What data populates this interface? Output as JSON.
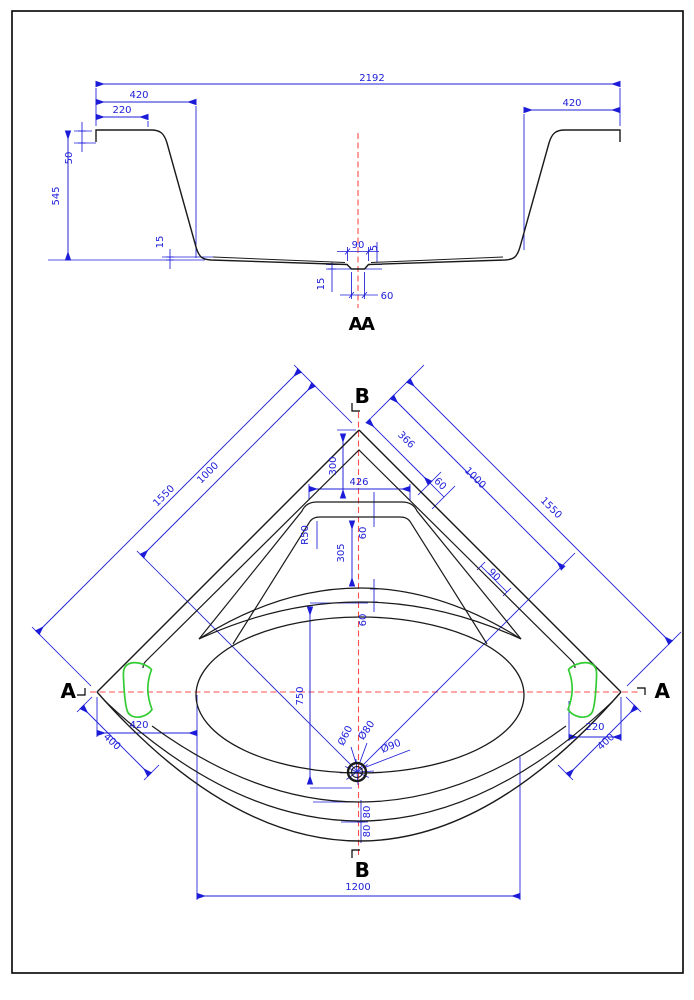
{
  "drawing_title": "",
  "colors": {
    "geometry": "#1a1a1a",
    "dimension": "#1c1cd8",
    "centerline": "#ff4d4d",
    "headrest": "#33cc33",
    "marker": "#000000",
    "page_border": "#000000",
    "background": "#ffffff"
  },
  "section_view": {
    "label": "AA",
    "dims": {
      "overall_width": "2192",
      "flange_left": "420",
      "flange_left_inner": "220",
      "flange_right": "420",
      "lip_height": "50",
      "total_height": "545",
      "bottom_step_left": "15",
      "recess_width_top": "90",
      "recess_depth": "5",
      "recess_side": "15",
      "recess_width_bottom": "60"
    }
  },
  "plan_view": {
    "markers": {
      "a": "A",
      "b": "B"
    },
    "dims": {
      "edge_left_total": "1550",
      "edge_left_to_drain": "1000",
      "edge_right_total": "1550",
      "edge_right_to_drain": "1000",
      "corner_to_shelf": "366",
      "shelf_edge_offset": "60",
      "rim_inner_gap": "90",
      "corner_drop": "300",
      "shelf_width": "426",
      "shelf_corner_radius": "R50",
      "shelf_height": "305",
      "shelf_gap": "60",
      "bowl_gap": "60",
      "drain_offset": "750",
      "drain_dia_1": "Ø60",
      "drain_dia_2": "Ø80",
      "drain_dia_3": "Ø90",
      "headrest_left_offset": "420",
      "apron_left": "400",
      "headrest_right_offset": "220",
      "apron_right": "400",
      "front_step_1": "80",
      "front_step_2": "80",
      "front_width": "1200"
    }
  }
}
